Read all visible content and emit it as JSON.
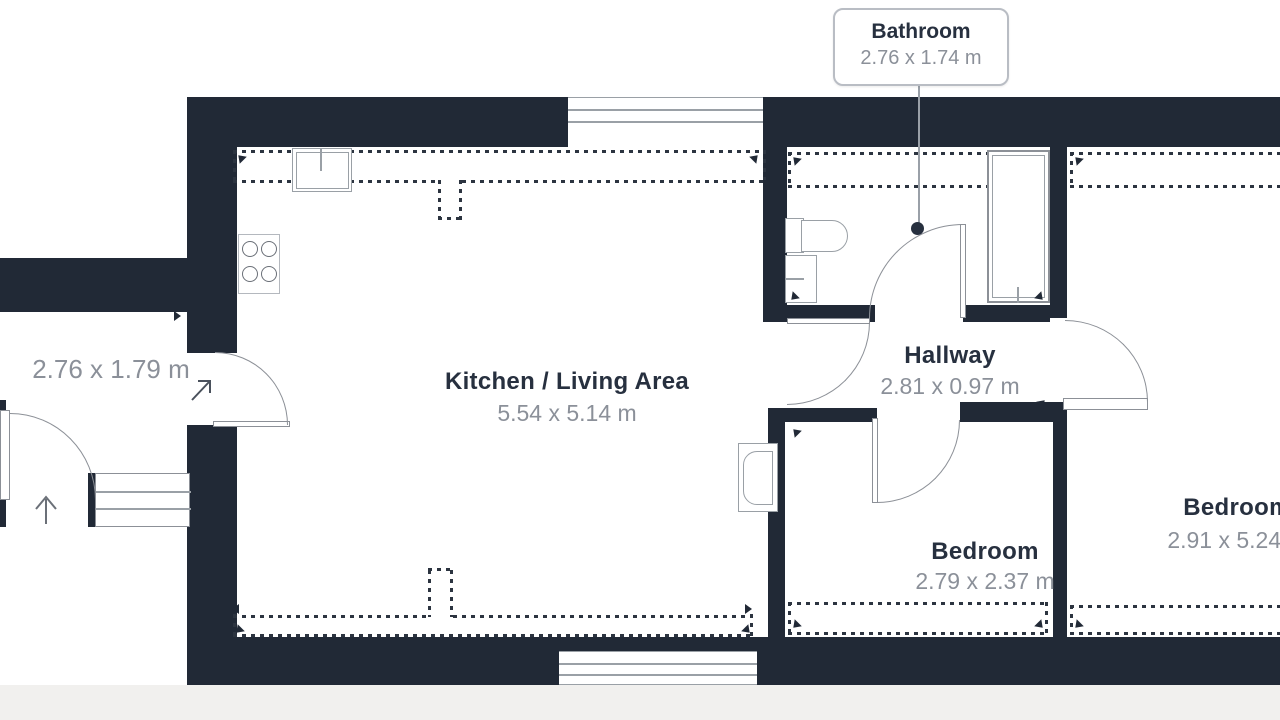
{
  "floorplan": {
    "background_color": "#ffffff",
    "wall_color": "#212936",
    "name_text_color": "#27303f",
    "dim_text_color": "#8b9099",
    "rooms": {
      "kitchen": {
        "name": "Kitchen / Living Area",
        "dims": "5.54 x 5.14 m"
      },
      "hallway": {
        "name": "Hallway",
        "dims": "2.81 x 0.97 m"
      },
      "bedroom1": {
        "name": "Bedroom",
        "dims": "2.79 x 2.37 m"
      },
      "bedroom2": {
        "name": "Bedroom",
        "dims": "2.91 x 5.24 m"
      },
      "entrance": {
        "dims": "2.76 x 1.79 m"
      }
    },
    "callout": {
      "title": "Bathroom",
      "dims": "2.76 x 1.74 m"
    },
    "icons": [
      "up-arrow",
      "entry-direction-arrow"
    ]
  }
}
